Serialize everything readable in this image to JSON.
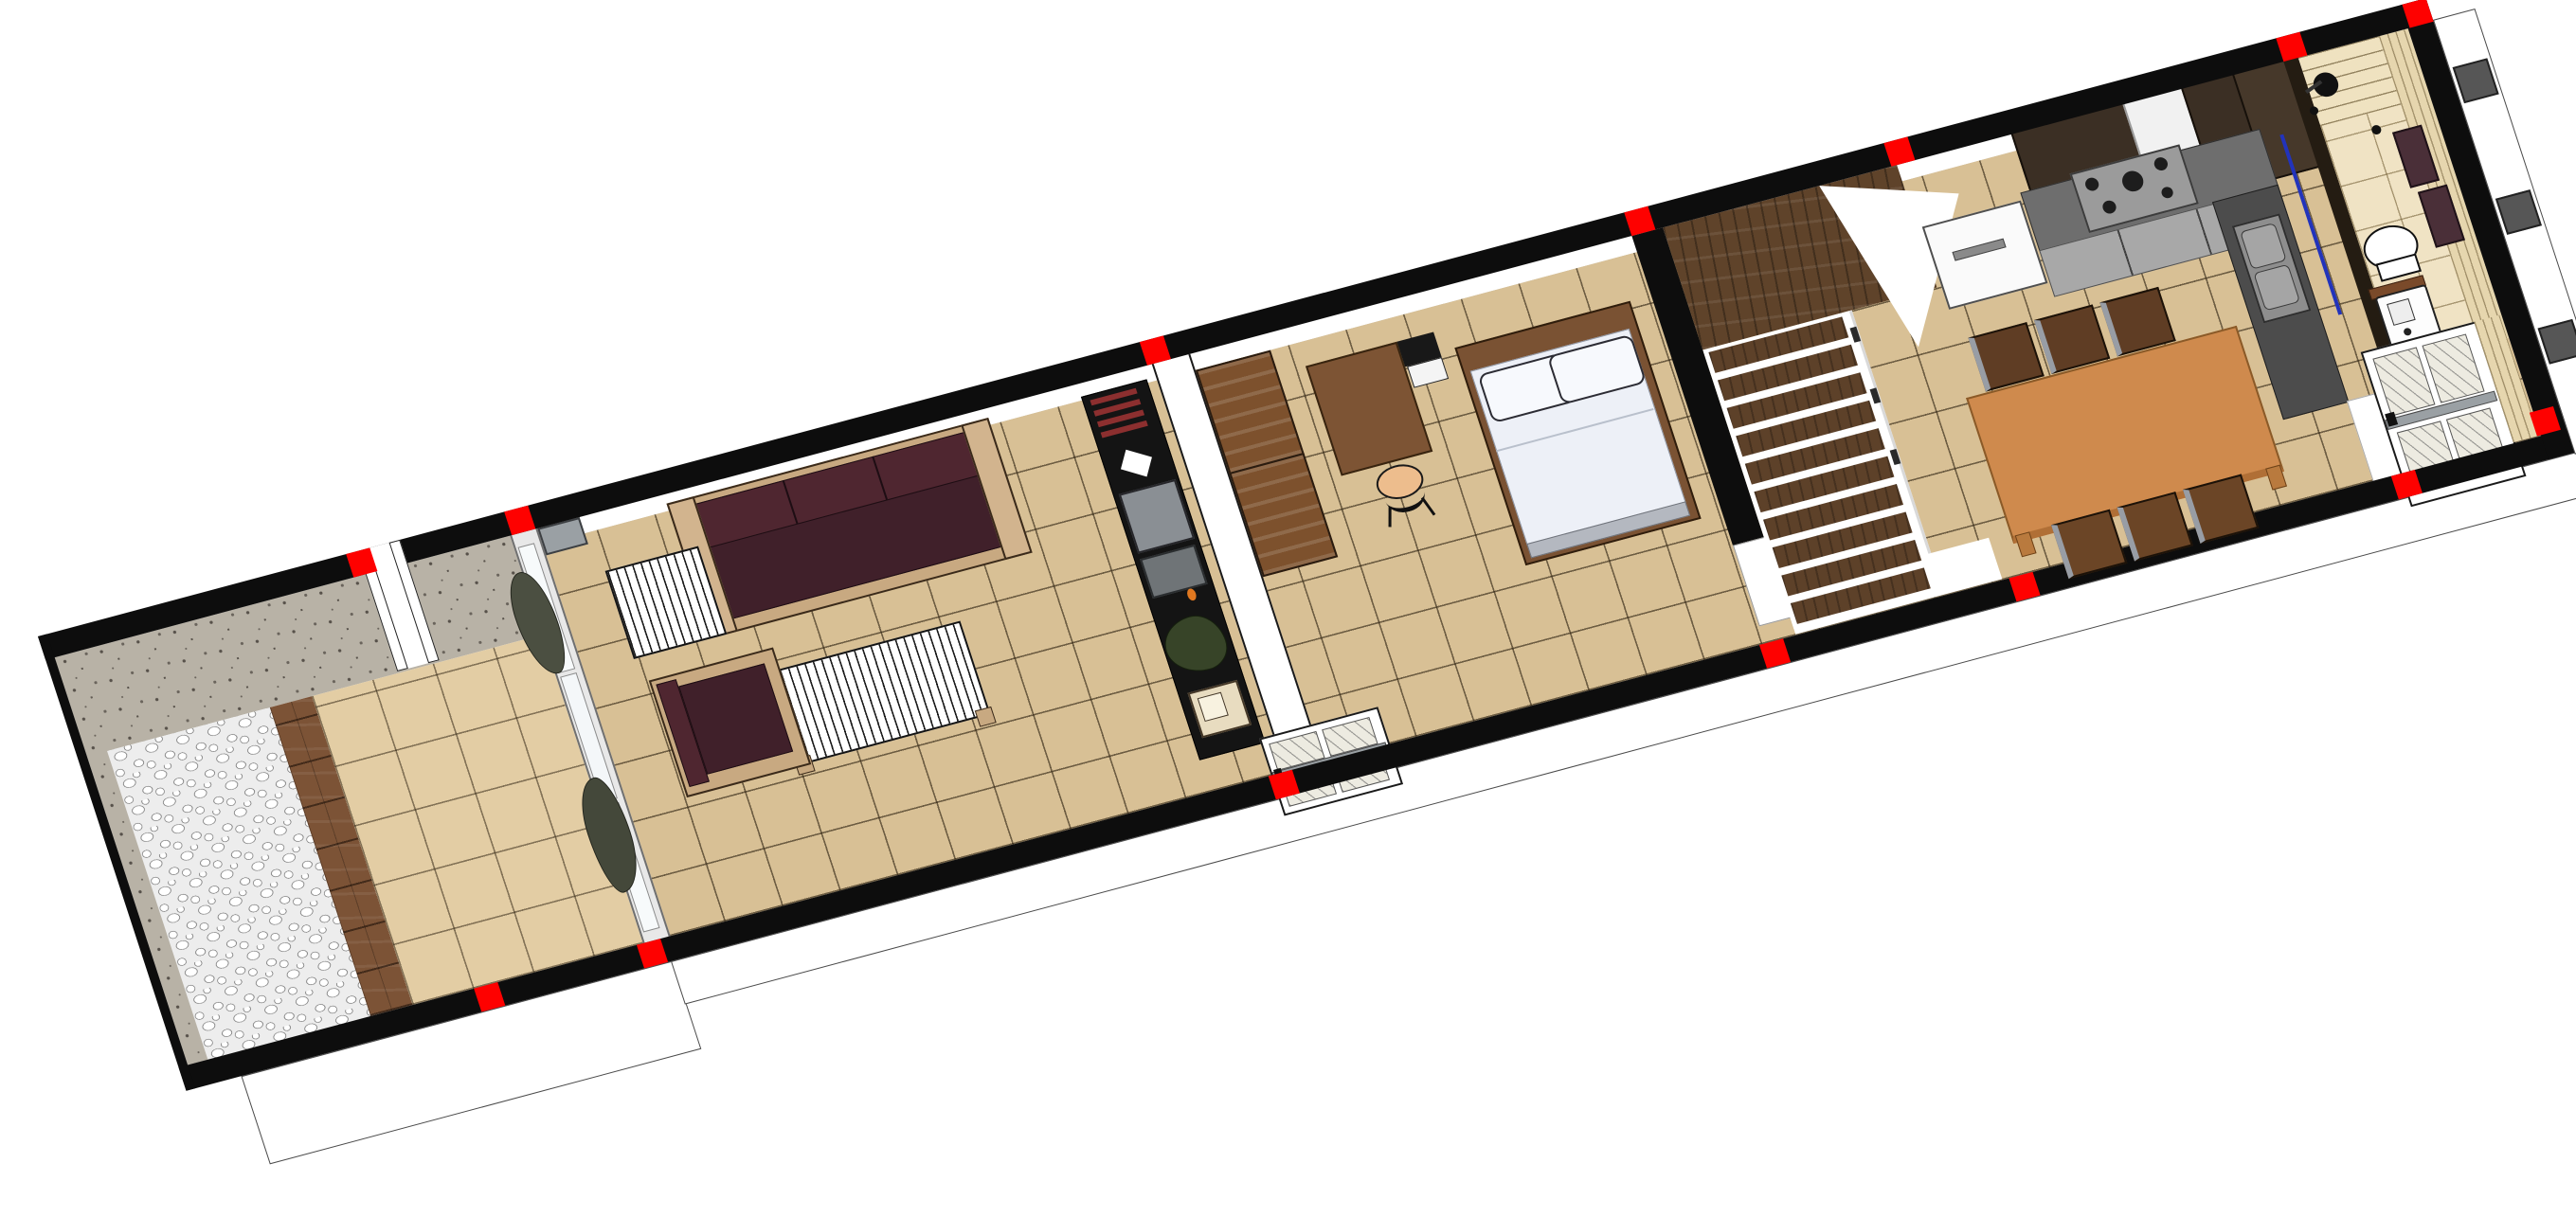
{
  "view": {
    "title": "3D axonometric floor plan of a long narrow row house",
    "style": "architectural BIM render",
    "background_color": "#ffffff",
    "wall_color": "#0d0d0d",
    "section_marker_color": "#fe0100"
  },
  "rooms": [
    {
      "id": "patio",
      "label": "Pebble patio with wood deck edge and stucco boundary walls"
    },
    {
      "id": "veranda",
      "label": "Tiled veranda behind glass sliding partition"
    },
    {
      "id": "living-room",
      "label": "Living room with sofa set and media wall"
    },
    {
      "id": "bedroom",
      "label": "Bedroom with double bed, desk and wardrobes"
    },
    {
      "id": "stair-hall",
      "label": "Winder staircase hall"
    },
    {
      "id": "dining",
      "label": "Dining area with table for six"
    },
    {
      "id": "kitchen",
      "label": "L-shaped kitchen with fridge, cooktop and sink"
    },
    {
      "id": "bathroom",
      "label": "Bathroom with shower, toilet and washing machine"
    },
    {
      "id": "entry",
      "label": "Entry vestibule with glazed front door"
    }
  ],
  "furniture": {
    "living": [
      "three-seat maroon sofa",
      "white slatted coffee table",
      "white slatted side table",
      "maroon armchair",
      "black media wall unit with books, tv, speakers, plant and retro radio"
    ],
    "bedroom": [
      "double bed with two pillows",
      "desk",
      "desk chair",
      "black nightstand",
      "two brown wardrobes"
    ],
    "dining": [
      "rectangular wooden table",
      "six wooden chairs"
    ],
    "kitchen": [
      "white refrigerator",
      "gas cooktop",
      "dark upper cabinets",
      "grey base cabinets",
      "double sink"
    ],
    "bathroom": [
      "shower head",
      "floor drain",
      "toilet",
      "washing machine",
      "two maroon towels"
    ]
  },
  "colors": {
    "tile_floor": "#d8c095",
    "veranda_tile": "#e3cda4",
    "bath_tile": "#f0e3c4",
    "sofa_cushion": "#40202a",
    "sofa_frame": "#c8a981",
    "dining_table": "#cf8a4d",
    "stair_wood": "#5f432a",
    "wardrobe_wood": "#7d512d",
    "deck_wood": "#7c5336",
    "stucco": "#b8b2a6",
    "counter_grey": "#6e6e6e",
    "accent_blue_door_edge": "#2233bb"
  },
  "markers": {
    "color": "#fe0100",
    "size": 26,
    "top": [
      337,
      510,
      1205,
      1735,
      2019,
      2448,
      2586
    ],
    "bottom": [
      323,
      501,
      1192,
      1729,
      2002,
      2420
    ],
    "corner": {
      "u": 2580,
      "v": 452
    }
  },
  "stairs": {
    "tread_count": 10,
    "first_v": 166,
    "step": 31
  },
  "media_wall": {
    "book_rows": [
      46,
      58,
      70,
      82
    ]
  },
  "dining": {
    "chair_rows": [
      {
        "cls": "chairback",
        "v": 222,
        "positions": [
          2040,
          2112,
          2184
        ]
      },
      {
        "cls": "chairback2",
        "v": 436,
        "positions": [
          2062,
          2134,
          2206
        ]
      }
    ]
  },
  "bed": {
    "pillows": 2
  },
  "counts": {
    "red_section_markers": 14,
    "exterior_grey_boxes": 3
  }
}
